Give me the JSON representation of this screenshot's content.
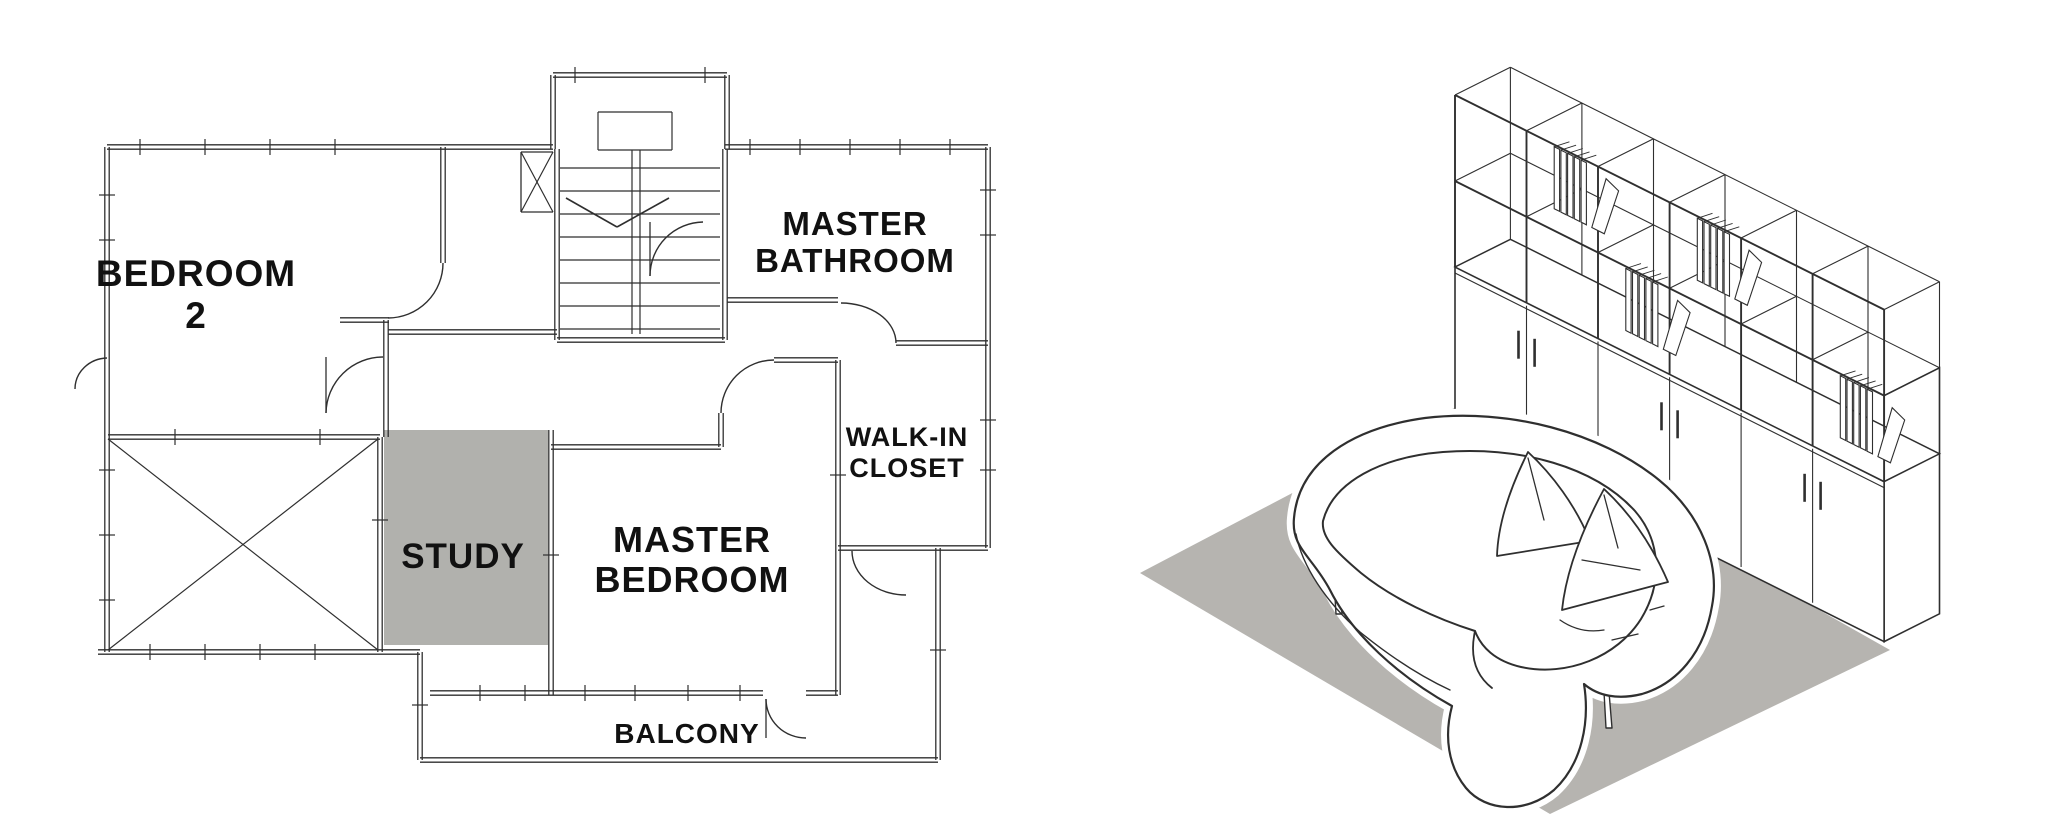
{
  "page": {
    "description": "Architectural drawing sheet: hand-sketched second-floor plan (left) and isometric interior view of a study with shelving wall and curved sofa (right)",
    "background_color": "#ffffff"
  },
  "floor_plan": {
    "rooms": [
      {
        "id": "bedroom-2",
        "label_lines": [
          "BEDROOM",
          "2"
        ],
        "highlighted": false
      },
      {
        "id": "master-bathroom",
        "label_lines": [
          "MASTER",
          "BATHROOM"
        ],
        "highlighted": false
      },
      {
        "id": "walk-in-closet",
        "label_lines": [
          "WALK-IN",
          "CLOSET"
        ],
        "highlighted": false
      },
      {
        "id": "study",
        "label_lines": [
          "STUDY"
        ],
        "highlighted": true,
        "highlight_color": "#b1b1ad"
      },
      {
        "id": "master-bedroom",
        "label_lines": [
          "MASTER",
          "BEDROOM"
        ],
        "highlighted": false
      },
      {
        "id": "balcony",
        "label_lines": [
          "BALCONY"
        ],
        "highlighted": false
      }
    ],
    "elements": [
      "staircase-with-direction-arrow",
      "stair-landing",
      "shaft-with-x-marker",
      "open-void-x-area",
      "door-swing-arcs",
      "window-tick-marks"
    ]
  },
  "isometric_view": {
    "elements": [
      {
        "id": "shelving-wall-unit",
        "parts": [
          "open-cube-shelves",
          "base-cabinets-with-doors",
          "door-handles",
          "books"
        ]
      },
      {
        "id": "curved-sofa",
        "parts": [
          "kidney-shaped-body",
          "throw-pillows",
          "tapered-legs"
        ]
      },
      {
        "id": "area-rug",
        "color": "#b6b4b0"
      }
    ]
  },
  "colors": {
    "line": "#2f2f2f",
    "label": "#111111",
    "study_highlight": "#b1b1ad",
    "rug": "#b6b4b0",
    "background": "#ffffff"
  }
}
